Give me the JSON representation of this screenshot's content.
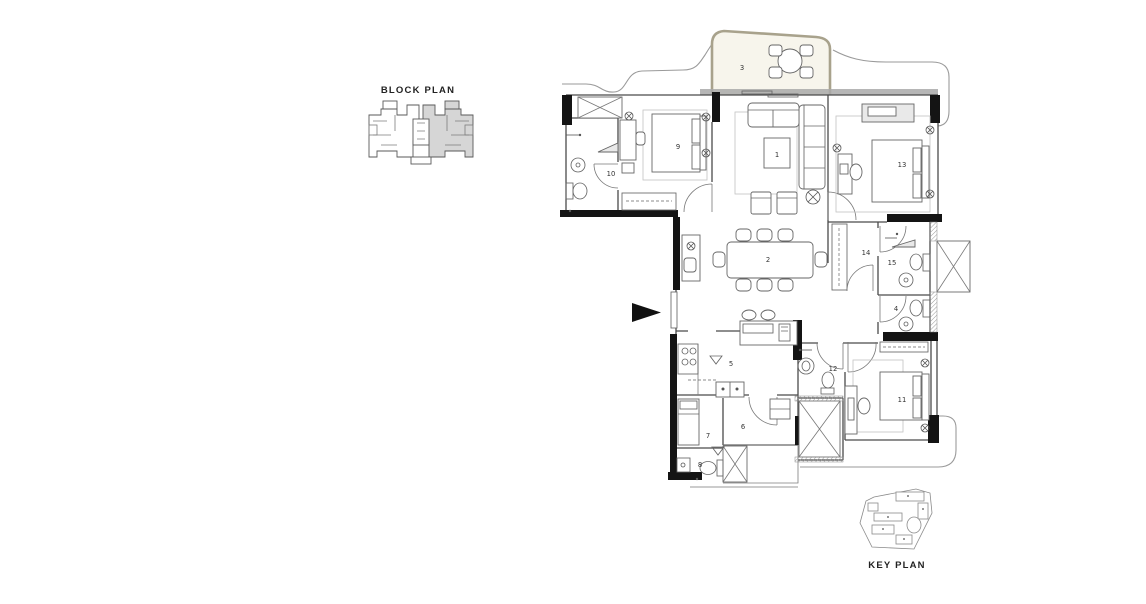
{
  "block_plan": {
    "title": "BLOCK PLAN"
  },
  "key_plan": {
    "title": "KEY PLAN"
  },
  "floor_plan": {
    "rooms": [
      {
        "number": "1"
      },
      {
        "number": "2"
      },
      {
        "number": "3"
      },
      {
        "number": "4"
      },
      {
        "number": "5"
      },
      {
        "number": "6"
      },
      {
        "number": "7"
      },
      {
        "number": "8"
      },
      {
        "number": "9"
      },
      {
        "number": "10"
      },
      {
        "number": "11"
      },
      {
        "number": "12"
      },
      {
        "number": "13"
      },
      {
        "number": "14"
      },
      {
        "number": "15"
      }
    ]
  },
  "colors": {
    "wall": "#141414",
    "line": "#4a4a4a",
    "light_line": "#9a9a9a",
    "balcony_wall": "#a8a28c",
    "window_band": "#a9a9a9",
    "shade_fill": "#d6d6d6",
    "background": "#ffffff",
    "text": "#222222"
  }
}
